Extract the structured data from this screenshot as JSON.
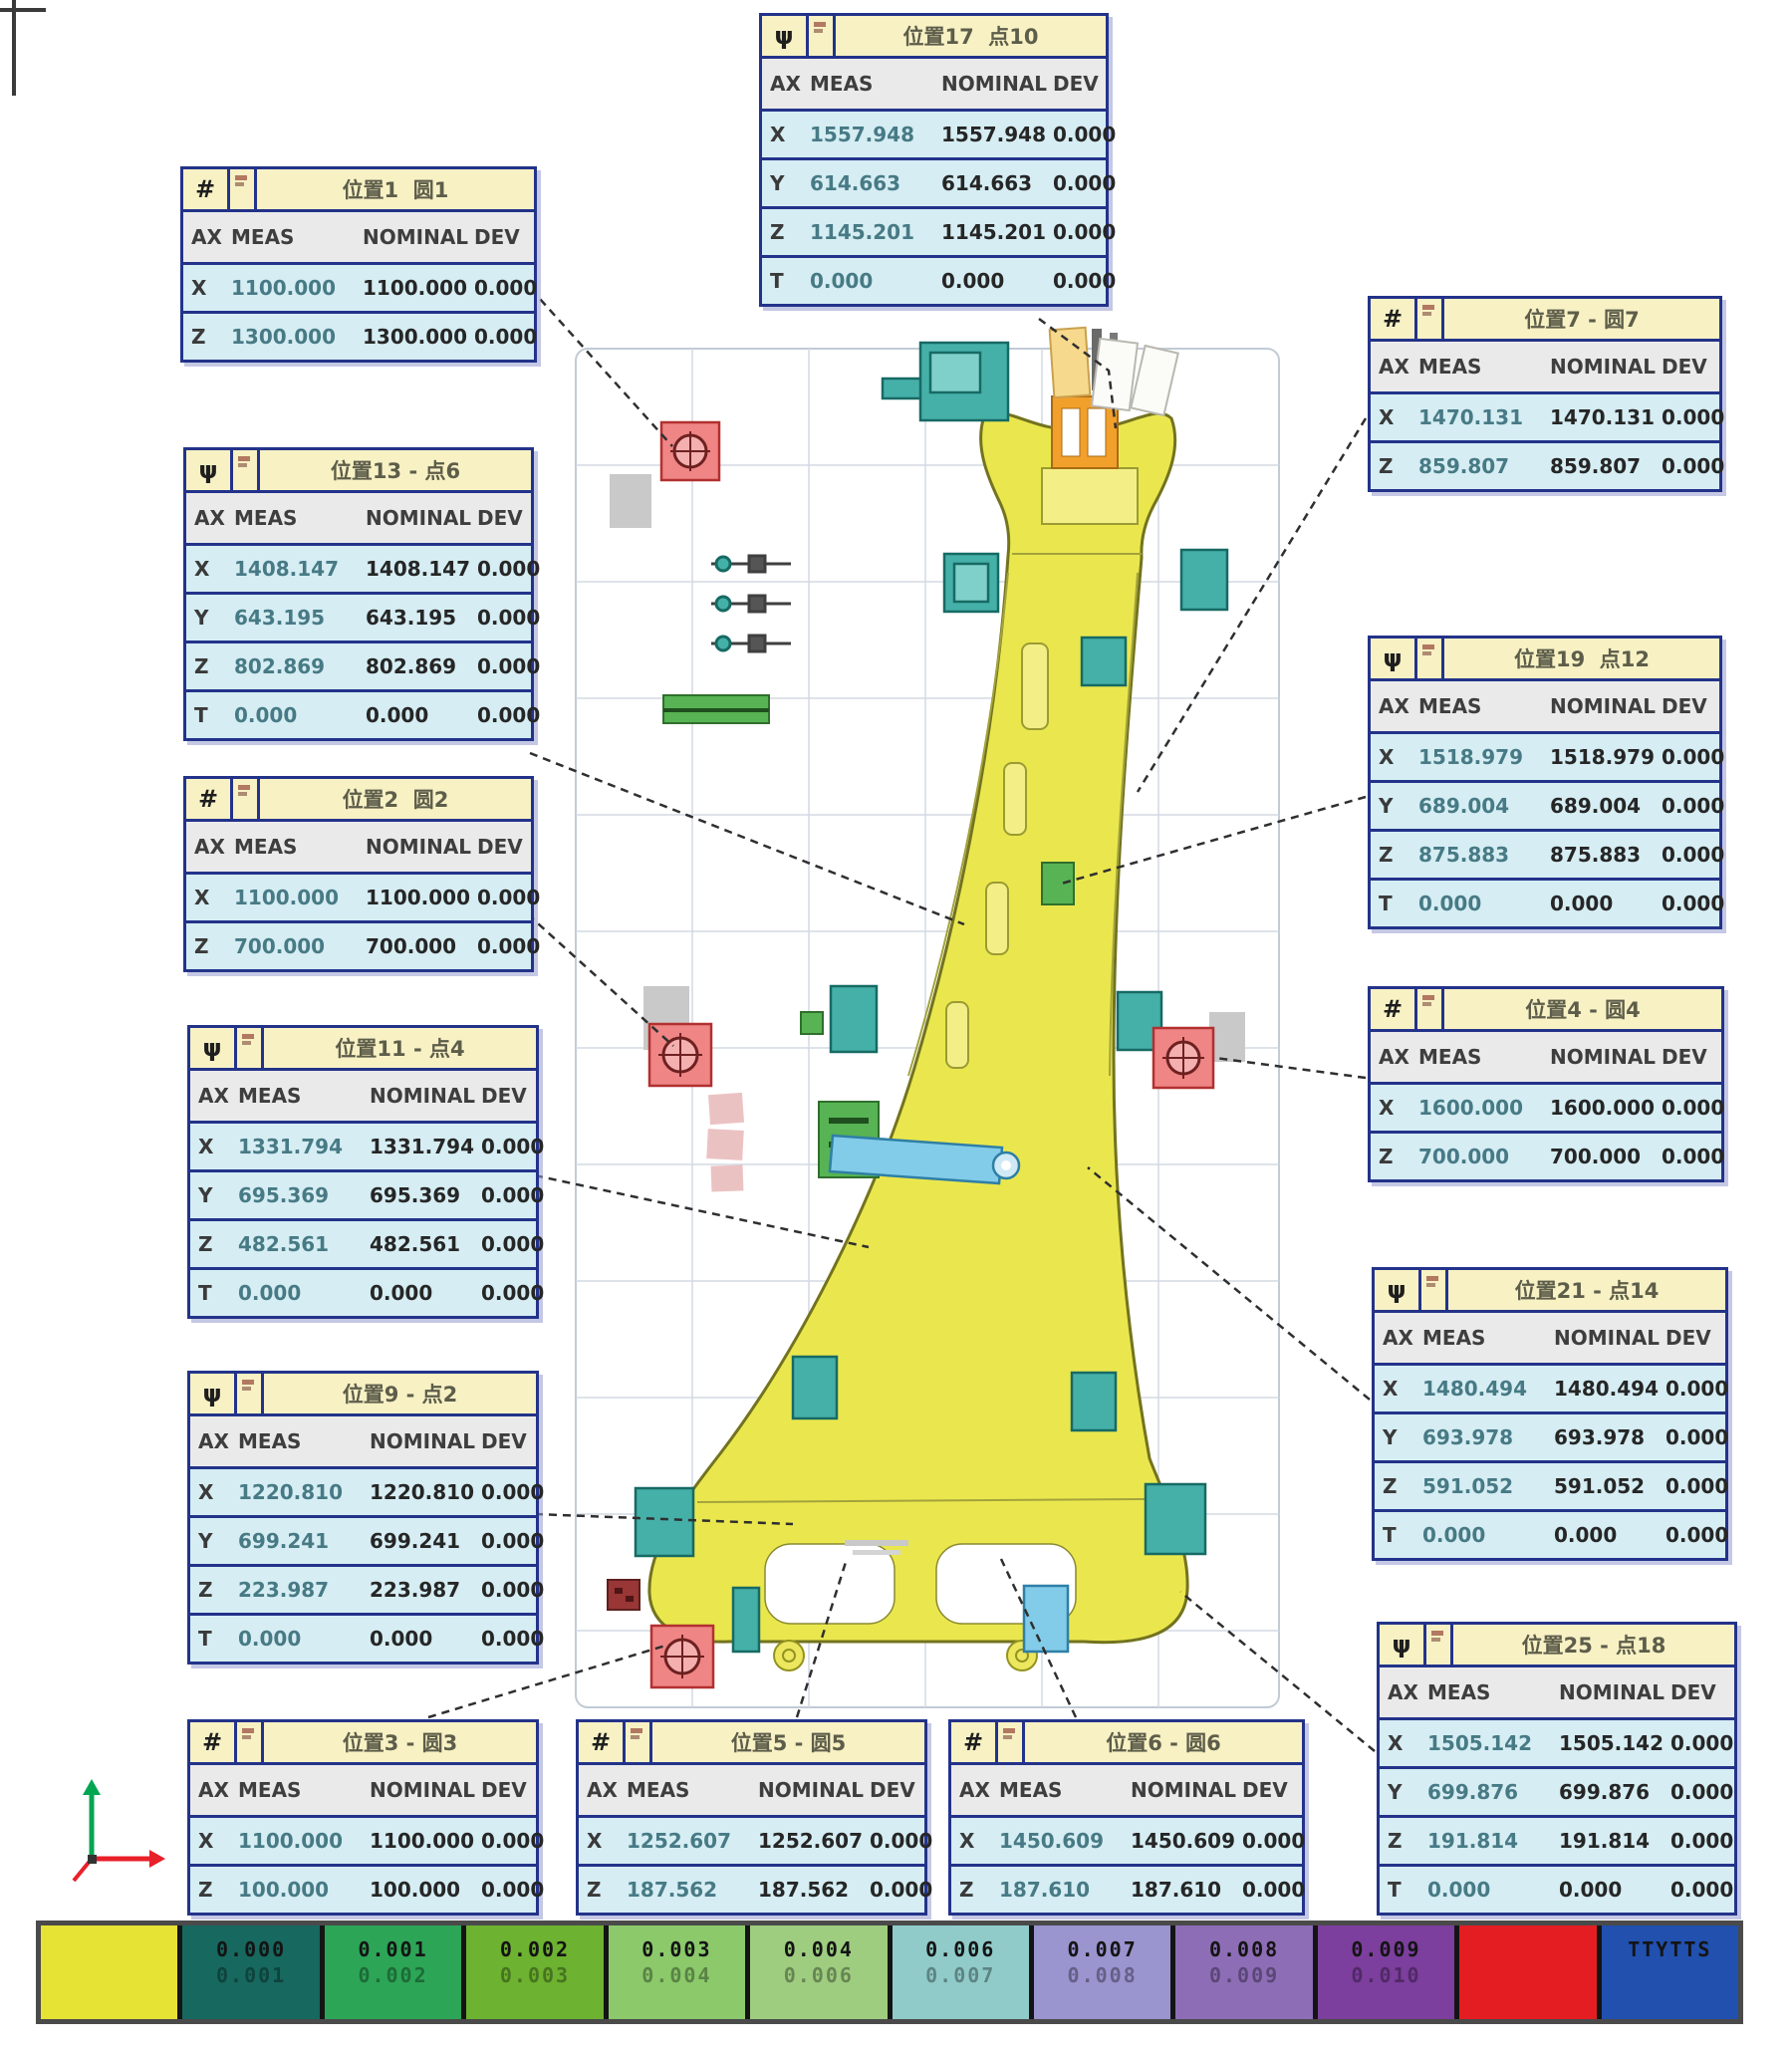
{
  "columns": {
    "ax": "AX",
    "meas": "MEAS",
    "nominal": "NOMINAL",
    "dev": "DEV"
  },
  "tables": [
    {
      "id": "pos1",
      "icon": "#",
      "title": "位置1  圆1",
      "rows": [
        [
          "X",
          "1100.000",
          "1100.000",
          "0.000"
        ],
        [
          "Z",
          "1300.000",
          "1300.000",
          "0.000"
        ]
      ]
    },
    {
      "id": "pos13",
      "icon": "ψ",
      "title": "位置13 - 点6",
      "rows": [
        [
          "X",
          "1408.147",
          "1408.147",
          "0.000"
        ],
        [
          "Y",
          "643.195",
          "643.195",
          "0.000"
        ],
        [
          "Z",
          "802.869",
          "802.869",
          "0.000"
        ],
        [
          "T",
          "0.000",
          "0.000",
          "0.000"
        ]
      ]
    },
    {
      "id": "pos2",
      "icon": "#",
      "title": "位置2  圆2",
      "rows": [
        [
          "X",
          "1100.000",
          "1100.000",
          "0.000"
        ],
        [
          "Z",
          "700.000",
          "700.000",
          "0.000"
        ]
      ]
    },
    {
      "id": "pos11",
      "icon": "ψ",
      "title": "位置11 - 点4",
      "rows": [
        [
          "X",
          "1331.794",
          "1331.794",
          "0.000"
        ],
        [
          "Y",
          "695.369",
          "695.369",
          "0.000"
        ],
        [
          "Z",
          "482.561",
          "482.561",
          "0.000"
        ],
        [
          "T",
          "0.000",
          "0.000",
          "0.000"
        ]
      ]
    },
    {
      "id": "pos9",
      "icon": "ψ",
      "title": "位置9 - 点2",
      "rows": [
        [
          "X",
          "1220.810",
          "1220.810",
          "0.000"
        ],
        [
          "Y",
          "699.241",
          "699.241",
          "0.000"
        ],
        [
          "Z",
          "223.987",
          "223.987",
          "0.000"
        ],
        [
          "T",
          "0.000",
          "0.000",
          "0.000"
        ]
      ]
    },
    {
      "id": "pos3",
      "icon": "#",
      "title": "位置3 - 圆3",
      "rows": [
        [
          "X",
          "1100.000",
          "1100.000",
          "0.000"
        ],
        [
          "Z",
          "100.000",
          "100.000",
          "0.000"
        ]
      ]
    },
    {
      "id": "pos5",
      "icon": "#",
      "title": "位置5 - 圆5",
      "rows": [
        [
          "X",
          "1252.607",
          "1252.607",
          "0.000"
        ],
        [
          "Z",
          "187.562",
          "187.562",
          "0.000"
        ]
      ]
    },
    {
      "id": "pos6",
      "icon": "#",
      "title": "位置6 - 圆6",
      "rows": [
        [
          "X",
          "1450.609",
          "1450.609",
          "0.000"
        ],
        [
          "Z",
          "187.610",
          "187.610",
          "0.000"
        ]
      ]
    },
    {
      "id": "pos17",
      "icon": "ψ",
      "title": "位置17  点10",
      "rows": [
        [
          "X",
          "1557.948",
          "1557.948",
          "0.000"
        ],
        [
          "Y",
          "614.663",
          "614.663",
          "0.000"
        ],
        [
          "Z",
          "1145.201",
          "1145.201",
          "0.000"
        ],
        [
          "T",
          "0.000",
          "0.000",
          "0.000"
        ]
      ]
    },
    {
      "id": "pos7",
      "icon": "#",
      "title": "位置7 - 圆7",
      "rows": [
        [
          "X",
          "1470.131",
          "1470.131",
          "0.000"
        ],
        [
          "Z",
          "859.807",
          "859.807",
          "0.000"
        ]
      ]
    },
    {
      "id": "pos19",
      "icon": "ψ",
      "title": "位置19  点12",
      "rows": [
        [
          "X",
          "1518.979",
          "1518.979",
          "0.000"
        ],
        [
          "Y",
          "689.004",
          "689.004",
          "0.000"
        ],
        [
          "Z",
          "875.883",
          "875.883",
          "0.000"
        ],
        [
          "T",
          "0.000",
          "0.000",
          "0.000"
        ]
      ]
    },
    {
      "id": "pos4",
      "icon": "#",
      "title": "位置4 - 圆4",
      "rows": [
        [
          "X",
          "1600.000",
          "1600.000",
          "0.000"
        ],
        [
          "Z",
          "700.000",
          "700.000",
          "0.000"
        ]
      ]
    },
    {
      "id": "pos21",
      "icon": "ψ",
      "title": "位置21 - 点14",
      "rows": [
        [
          "X",
          "1480.494",
          "1480.494",
          "0.000"
        ],
        [
          "Y",
          "693.978",
          "693.978",
          "0.000"
        ],
        [
          "Z",
          "591.052",
          "591.052",
          "0.000"
        ],
        [
          "T",
          "0.000",
          "0.000",
          "0.000"
        ]
      ]
    },
    {
      "id": "pos25",
      "icon": "ψ",
      "title": "位置25 - 点18",
      "rows": [
        [
          "X",
          "1505.142",
          "1505.142",
          "0.000"
        ],
        [
          "Y",
          "699.876",
          "699.876",
          "0.000"
        ],
        [
          "Z",
          "191.814",
          "191.814",
          "0.000"
        ],
        [
          "T",
          "0.000",
          "0.000",
          "0.000"
        ]
      ]
    }
  ],
  "legend": {
    "segments": [
      {
        "color": "#e6e335",
        "top": "",
        "bottom": ""
      },
      {
        "color": "#17685f",
        "top": "0.000",
        "bottom": "0.001"
      },
      {
        "color": "#2da557",
        "top": "0.001",
        "bottom": "0.002"
      },
      {
        "color": "#6db230",
        "top": "0.002",
        "bottom": "0.003"
      },
      {
        "color": "#8bc96b",
        "top": "0.003",
        "bottom": "0.004"
      },
      {
        "color": "#9ecd80",
        "top": "0.004",
        "bottom": "0.006"
      },
      {
        "color": "#90cbc9",
        "top": "0.006",
        "bottom": "0.007"
      },
      {
        "color": "#9a94cf",
        "top": "0.007",
        "bottom": "0.008"
      },
      {
        "color": "#8d6db6",
        "top": "0.008",
        "bottom": "0.009"
      },
      {
        "color": "#7c3f9d",
        "top": "0.009",
        "bottom": "0.010"
      },
      {
        "color": "#e41d23",
        "top": "",
        "bottom": ""
      },
      {
        "color": "#2150ae",
        "top": "TTYTTS",
        "bottom": ""
      }
    ]
  },
  "colors": {
    "table_border": "#23338a",
    "table_title_bg": "#f7f1c4",
    "table_header_bg": "#eaeaea",
    "table_row_bg": "#d5edf3",
    "part_fill": "#eae74e",
    "part_stroke": "#73731f",
    "fixture_teal": "#45b0a8",
    "fixture_green": "#57b353",
    "fixture_cyan": "#82cce9",
    "fixture_orange": "#f2a02c",
    "pad_red": "#ef8585",
    "axis_green": "#00a651",
    "axis_red": "#e8202a"
  }
}
